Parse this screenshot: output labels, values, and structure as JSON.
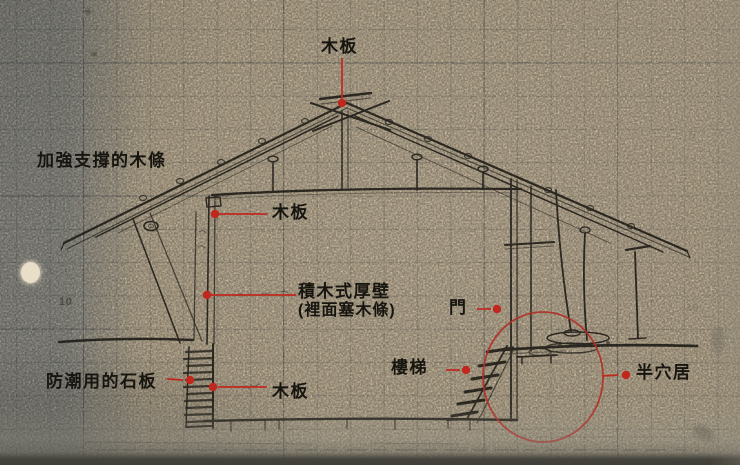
{
  "labels": {
    "roof_plank_top": "木板",
    "reinforcing_wood_strips": "加強支撐的木條",
    "wall_plank": "木板",
    "stacked_timber_wall_line1": "積木式厚壁",
    "stacked_timber_wall_line2": "(裡面塞木條)",
    "door": "門",
    "stairs": "樓梯",
    "damp_proof_stone_slabs": "防潮用的石板",
    "floor_plank": "木板",
    "half_pit_dwelling": "半穴居"
  },
  "paper_marks": {
    "left_ten": "10",
    "right_ten": "10",
    "right_five": "5"
  },
  "colors": {
    "paper": "#d5c5a8",
    "left_band_gray": "#a3a29a",
    "pencil_ink": "#2b2820",
    "annotation_red": "#c0281e",
    "highlight_circle_red": "#b03028",
    "grid_line": "#4c5158",
    "bottom_edge": "#413f38"
  }
}
